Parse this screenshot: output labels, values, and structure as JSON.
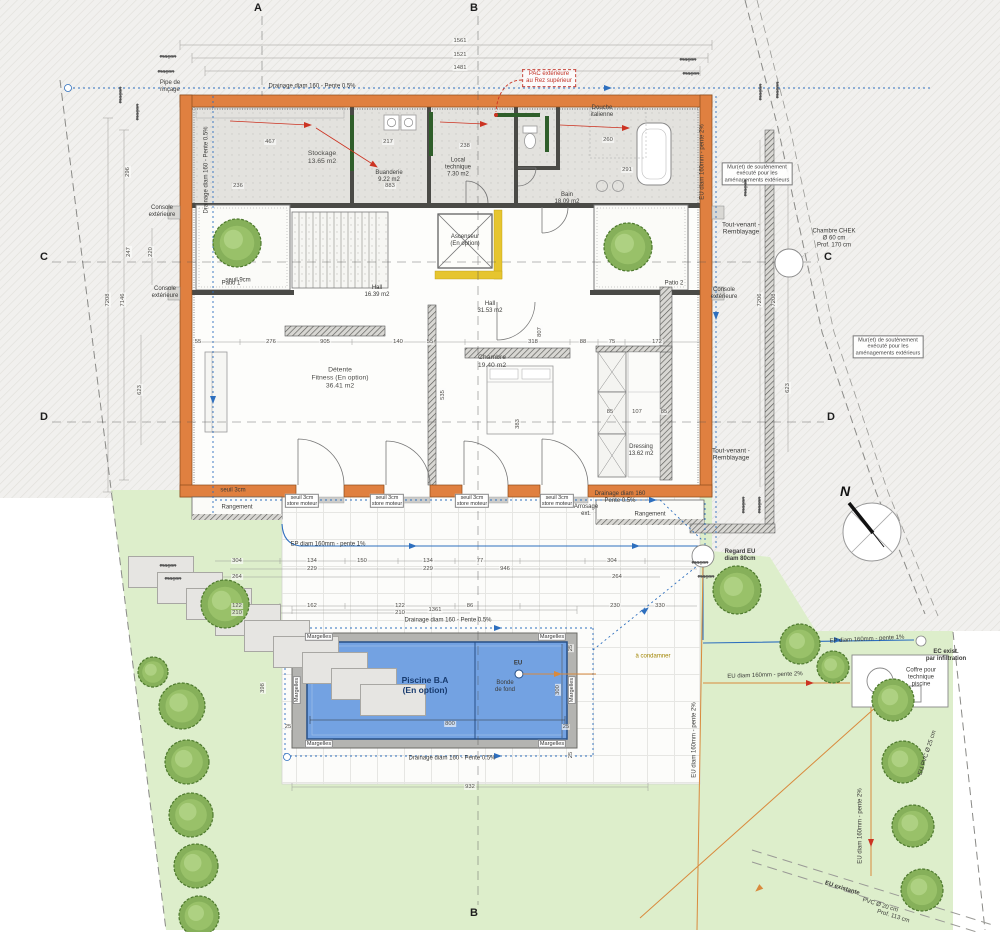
{
  "colors": {
    "wall_orange": "#e08040",
    "water_blue": "#73a2e2",
    "lawn_green": "#ddeecb",
    "terrain_hatch": "#f1f0ee",
    "line_blue": "#2e6fbe",
    "line_orange": "#d98a3d",
    "accent_red": "#cc3322",
    "insulation_yellow": "#e6c52f",
    "frame_green": "#2f5e2a"
  },
  "labels": [
    {
      "n": "pipe-rincage",
      "t": "Pipe de\nrinçage",
      "x": 170,
      "y": 87,
      "c": "xs"
    },
    {
      "n": "drainage-top",
      "t": "Drainage diam 160 - Pente 0.5%",
      "x": 312,
      "y": 87,
      "c": "xs"
    },
    {
      "n": "drainage-left",
      "t": "Drainage diam 160 - Pente 0.5%",
      "x": 207,
      "y": 170,
      "r": -90,
      "c": "xs"
    },
    {
      "n": "drainage-right",
      "t": "Drainage diam 160\nPente 0.5%",
      "x": 620,
      "y": 498,
      "c": "xs"
    },
    {
      "n": "drainage-pool-top",
      "t": "Drainage diam 160 - Pente 0.5%",
      "x": 448,
      "y": 621,
      "c": "xs"
    },
    {
      "n": "drainage-pool-bottom",
      "t": "Drainage diam 160 - Pente 0.5%",
      "x": 452,
      "y": 759,
      "c": "xs"
    },
    {
      "n": "ep-line-1",
      "t": "EP diam 160mm - pente 1%",
      "x": 328,
      "y": 545,
      "c": "xs"
    },
    {
      "n": "ep-line-2",
      "t": "EP diam 160mm - pente 1%",
      "x": 867,
      "y": 640,
      "r": -3,
      "c": "xs"
    },
    {
      "n": "eu-line-h",
      "t": "EU diam 160mm - pente 2%",
      "x": 765,
      "y": 676,
      "r": -2,
      "c": "xs"
    },
    {
      "n": "eu-line-v1",
      "t": "EU diam 160mm - pente 2%",
      "x": 695,
      "y": 740,
      "r": -90,
      "c": "xs"
    },
    {
      "n": "eu-line-v2",
      "t": "EU diam 160mm - pente 2%",
      "x": 861,
      "y": 826,
      "r": -90,
      "c": "xs"
    },
    {
      "n": "eu-line-v3",
      "t": "EU diam 160mm - pente 2%",
      "x": 703,
      "y": 162,
      "r": -90,
      "c": "xs"
    },
    {
      "n": "ec-exist",
      "t": "EC exist.\npar infiltration",
      "x": 946,
      "y": 656,
      "c": "xs bold"
    },
    {
      "n": "regard-eu",
      "t": "Regard EU\ndiam 80cm",
      "x": 740,
      "y": 556,
      "c": "xs bold"
    },
    {
      "n": "coffre-technique",
      "t": "Coffre pour\ntechnique\npiscine",
      "x": 921,
      "y": 678,
      "c": "xs"
    },
    {
      "n": "tout-venant-1",
      "t": "Tout-venant -\nRemblayage",
      "x": 741,
      "y": 229,
      "c": "sm"
    },
    {
      "n": "tout-venant-2",
      "t": "Tout-venant -\nRemblayage",
      "x": 731,
      "y": 455,
      "c": "sm"
    },
    {
      "n": "muret-soutenement-1",
      "t": "Mur(et) de soutènement\nexécuté pour les\naménagements extérieurs",
      "x": 757,
      "y": 174,
      "c": "box"
    },
    {
      "n": "muret-soutenement-2",
      "t": "Mur(et) de soutènement\nexécuté pour les\naménagements extérieurs",
      "x": 888,
      "y": 347,
      "c": "box"
    },
    {
      "n": "chambre-chek",
      "t": "Chambre CHEK\nØ 60 cm\nProf. 170 cm",
      "x": 834,
      "y": 239,
      "c": "xs"
    },
    {
      "n": "pac-exterieure",
      "t": "PAC extérieure\nau Rez supérieur",
      "x": 549,
      "y": 78,
      "c": "redbox"
    },
    {
      "n": "eu-existante",
      "t": "EU existante",
      "x": 842,
      "y": 889,
      "r": 17,
      "c": "xs bold"
    },
    {
      "n": "eu-existante-pvc",
      "t": "PVC Ø 20 cm",
      "x": 880,
      "y": 906,
      "r": 17,
      "c": "xs"
    },
    {
      "n": "eu-existante-prof",
      "t": "Prof. 113 cm",
      "x": 893,
      "y": 917,
      "r": 17,
      "c": "xs"
    },
    {
      "n": "eu-pvc-25",
      "t": "EU PVC Ø 25 cm",
      "x": 928,
      "y": 753,
      "r": -72,
      "c": "xs"
    },
    {
      "n": "a-condamner",
      "t": "à condamner",
      "x": 653,
      "y": 657,
      "c": "xs olive"
    },
    {
      "n": "margelles-1",
      "t": "Margelles",
      "x": 319,
      "y": 637,
      "c": "chip"
    },
    {
      "n": "margelles-2",
      "t": "Margelles",
      "x": 552,
      "y": 637,
      "c": "chip"
    },
    {
      "n": "margelles-3",
      "t": "Margelles",
      "x": 319,
      "y": 744,
      "c": "chip"
    },
    {
      "n": "margelles-4",
      "t": "Margelles",
      "x": 552,
      "y": 744,
      "c": "chip"
    },
    {
      "n": "margelles-5",
      "t": "Margelles",
      "x": 297,
      "y": 690,
      "r": -90,
      "c": "chip"
    },
    {
      "n": "margelles-6",
      "t": "Margelles",
      "x": 572,
      "y": 690,
      "r": -90,
      "c": "chip"
    },
    {
      "n": "piscine-title",
      "t": "Piscine B.A\n(En option)",
      "x": 425,
      "y": 686,
      "c": "pool-title"
    },
    {
      "n": "bonde-de-fond",
      "t": "Bonde\nde fond",
      "x": 505,
      "y": 687,
      "c": "xs"
    },
    {
      "n": "eu-bonde",
      "t": "EU",
      "x": 518,
      "y": 664,
      "c": "xs bold"
    },
    {
      "n": "room-stockage",
      "t": "Stockage\n13.65 m2",
      "x": 322,
      "y": 158,
      "c": "room"
    },
    {
      "n": "room-buanderie",
      "t": "Buanderie\n9.22 m2",
      "x": 389,
      "y": 177,
      "c": "xs"
    },
    {
      "n": "room-local-technique",
      "t": "Local\ntechnique\n7.30 m2",
      "x": 458,
      "y": 168,
      "c": "xs"
    },
    {
      "n": "room-douche",
      "t": "Douche\nitalienne",
      "x": 602,
      "y": 112,
      "c": "xs"
    },
    {
      "n": "room-bain",
      "t": "Bain\n18.09 m2",
      "x": 567,
      "y": 199,
      "c": "xs"
    },
    {
      "n": "room-hall-1",
      "t": "Hall\n16.39 m2",
      "x": 377,
      "y": 292,
      "c": "xs"
    },
    {
      "n": "room-hall-2",
      "t": "Hall\n31.53 m2",
      "x": 490,
      "y": 308,
      "c": "xs"
    },
    {
      "n": "room-ascenseur",
      "t": "Ascenseur\n(En option)",
      "x": 465,
      "y": 241,
      "c": "xs"
    },
    {
      "n": "room-detente",
      "t": "Détente\nFitness (En option)\n36.41 m2",
      "x": 340,
      "y": 378,
      "c": "room"
    },
    {
      "n": "room-chambre",
      "t": "Chambre\n19.40 m2",
      "x": 492,
      "y": 362,
      "c": "room"
    },
    {
      "n": "room-dressing",
      "t": "Dressing\n13.62 m2",
      "x": 641,
      "y": 451,
      "c": "xs"
    },
    {
      "n": "room-patio-1",
      "t": "Patio 1",
      "x": 231,
      "y": 284,
      "c": "xs"
    },
    {
      "n": "room-patio-2",
      "t": "Patio 2",
      "x": 674,
      "y": 284,
      "c": "xs"
    },
    {
      "n": "room-rangement-l",
      "t": "Rangement",
      "x": 237,
      "y": 508,
      "c": "xs"
    },
    {
      "n": "room-rangement-r",
      "t": "Rangement",
      "x": 650,
      "y": 515,
      "c": "xs"
    },
    {
      "n": "arrosage-ext",
      "t": "Arrosage\next.",
      "x": 586,
      "y": 511,
      "c": "xs"
    },
    {
      "n": "console-ext-1",
      "t": "Console\nextérieure",
      "x": 162,
      "y": 212,
      "c": "xs"
    },
    {
      "n": "console-ext-2",
      "t": "Console\nextérieure",
      "x": 165,
      "y": 293,
      "c": "xs"
    },
    {
      "n": "console-ext-3",
      "t": "Console\nextérieure",
      "x": 724,
      "y": 294,
      "c": "xs"
    },
    {
      "n": "seuil-1",
      "t": "seuil 3cm\nstore moteur",
      "x": 302,
      "y": 501,
      "c": "chip2"
    },
    {
      "n": "seuil-2",
      "t": "seuil 3cm\nstore moteur",
      "x": 387,
      "y": 501,
      "c": "chip2"
    },
    {
      "n": "seuil-3",
      "t": "seuil 3cm\nstore moteur",
      "x": 472,
      "y": 501,
      "c": "chip2"
    },
    {
      "n": "seuil-4",
      "t": "seuil 3cm\nstore moteur",
      "x": 557,
      "y": 501,
      "c": "chip2"
    },
    {
      "n": "seuil-5",
      "t": "seuil 3cm",
      "x": 233,
      "y": 491,
      "c": "xs"
    },
    {
      "n": "seuil-6",
      "t": "seuil 9cm",
      "x": 238,
      "y": 281,
      "c": "xs"
    },
    {
      "n": "macon-1",
      "t": "maçon",
      "x": 168,
      "y": 57,
      "c": "strike"
    },
    {
      "n": "macon-2",
      "t": "maçon",
      "x": 166,
      "y": 72,
      "c": "strike"
    },
    {
      "n": "macon-3",
      "t": "maçon",
      "x": 688,
      "y": 60,
      "c": "strike"
    },
    {
      "n": "macon-4",
      "t": "maçon",
      "x": 691,
      "y": 74,
      "c": "strike"
    },
    {
      "n": "macon-5",
      "t": "maçon",
      "x": 761,
      "y": 92,
      "r": -90,
      "c": "strike"
    },
    {
      "n": "macon-6",
      "t": "maçon",
      "x": 778,
      "y": 90,
      "r": -90,
      "c": "strike"
    },
    {
      "n": "macon-7",
      "t": "maçon",
      "x": 121,
      "y": 95,
      "r": -90,
      "c": "strike"
    },
    {
      "n": "macon-8",
      "t": "maçon",
      "x": 138,
      "y": 112,
      "r": -90,
      "c": "strike"
    },
    {
      "n": "macon-9",
      "t": "maçon",
      "x": 746,
      "y": 188,
      "r": -90,
      "c": "strike"
    },
    {
      "n": "macon-10",
      "t": "maçon",
      "x": 744,
      "y": 505,
      "r": -90,
      "c": "strike"
    },
    {
      "n": "macon-11",
      "t": "maçon",
      "x": 760,
      "y": 505,
      "r": -90,
      "c": "strike"
    },
    {
      "n": "macon-12",
      "t": "maçon",
      "x": 168,
      "y": 566,
      "c": "strike"
    },
    {
      "n": "macon-13",
      "t": "maçon",
      "x": 173,
      "y": 579,
      "c": "strike"
    },
    {
      "n": "macon-14",
      "t": "maçon",
      "x": 700,
      "y": 563,
      "c": "strike"
    },
    {
      "n": "macon-15",
      "t": "maçon",
      "x": 706,
      "y": 577,
      "c": "strike"
    },
    {
      "n": "compass-letter",
      "t": "N",
      "x": 845,
      "y": 491,
      "c": "compassn"
    }
  ],
  "dims": [
    {
      "t": "1561",
      "x": 460,
      "y": 41
    },
    {
      "t": "1521",
      "x": 460,
      "y": 55
    },
    {
      "t": "1481",
      "x": 460,
      "y": 68
    },
    {
      "t": "7208",
      "x": 108,
      "y": 300,
      "r": -90
    },
    {
      "t": "7146",
      "x": 123,
      "y": 300,
      "r": -90
    },
    {
      "t": "623",
      "x": 140,
      "y": 390,
      "r": -90
    },
    {
      "t": "247",
      "x": 129,
      "y": 252,
      "r": -90
    },
    {
      "t": "220",
      "x": 151,
      "y": 252,
      "r": -90
    },
    {
      "t": "296",
      "x": 128,
      "y": 172,
      "r": -90
    },
    {
      "t": "398",
      "x": 263,
      "y": 688,
      "r": -90
    },
    {
      "t": "7206",
      "x": 760,
      "y": 300,
      "r": -90
    },
    {
      "t": "7208",
      "x": 774,
      "y": 300,
      "r": -90
    },
    {
      "t": "623",
      "x": 788,
      "y": 388,
      "r": -90
    },
    {
      "t": "467",
      "x": 270,
      "y": 142
    },
    {
      "t": "217",
      "x": 388,
      "y": 142
    },
    {
      "t": "236",
      "x": 238,
      "y": 186
    },
    {
      "t": "883",
      "x": 390,
      "y": 186
    },
    {
      "t": "238",
      "x": 465,
      "y": 146
    },
    {
      "t": "291",
      "x": 627,
      "y": 170
    },
    {
      "t": "260",
      "x": 608,
      "y": 140
    },
    {
      "t": "55",
      "x": 198,
      "y": 342
    },
    {
      "t": "276",
      "x": 271,
      "y": 342
    },
    {
      "t": "905",
      "x": 325,
      "y": 342
    },
    {
      "t": "140",
      "x": 398,
      "y": 342
    },
    {
      "t": "55",
      "x": 430,
      "y": 342
    },
    {
      "t": "318",
      "x": 533,
      "y": 342
    },
    {
      "t": "88",
      "x": 583,
      "y": 342
    },
    {
      "t": "75",
      "x": 612,
      "y": 342
    },
    {
      "t": "172",
      "x": 657,
      "y": 342
    },
    {
      "t": "535",
      "x": 443,
      "y": 395,
      "r": -90
    },
    {
      "t": "383",
      "x": 518,
      "y": 424,
      "r": -90
    },
    {
      "t": "807",
      "x": 540,
      "y": 332,
      "r": -90
    },
    {
      "t": "85",
      "x": 610,
      "y": 412
    },
    {
      "t": "107",
      "x": 637,
      "y": 412
    },
    {
      "t": "85",
      "x": 664,
      "y": 412
    },
    {
      "t": "304",
      "x": 237,
      "y": 561
    },
    {
      "t": "134",
      "x": 312,
      "y": 561
    },
    {
      "t": "150",
      "x": 362,
      "y": 561
    },
    {
      "t": "134",
      "x": 428,
      "y": 561
    },
    {
      "t": "77",
      "x": 480,
      "y": 561
    },
    {
      "t": "304",
      "x": 612,
      "y": 561
    },
    {
      "t": "229",
      "x": 312,
      "y": 569
    },
    {
      "t": "229",
      "x": 428,
      "y": 569
    },
    {
      "t": "946",
      "x": 505,
      "y": 569
    },
    {
      "t": "264",
      "x": 237,
      "y": 577
    },
    {
      "t": "264",
      "x": 617,
      "y": 577
    },
    {
      "t": "122",
      "x": 237,
      "y": 606
    },
    {
      "t": "162",
      "x": 312,
      "y": 606
    },
    {
      "t": "122",
      "x": 400,
      "y": 606
    },
    {
      "t": "86",
      "x": 470,
      "y": 606
    },
    {
      "t": "230",
      "x": 615,
      "y": 606
    },
    {
      "t": "330",
      "x": 660,
      "y": 606
    },
    {
      "t": "210",
      "x": 237,
      "y": 613
    },
    {
      "t": "210",
      "x": 400,
      "y": 613
    },
    {
      "t": "1361",
      "x": 435,
      "y": 610
    },
    {
      "t": "932",
      "x": 470,
      "y": 787
    },
    {
      "t": "800",
      "x": 450,
      "y": 724
    },
    {
      "t": "25",
      "x": 288,
      "y": 727
    },
    {
      "t": "25",
      "x": 566,
      "y": 727
    },
    {
      "t": "25",
      "x": 571,
      "y": 648,
      "r": -90
    },
    {
      "t": "25",
      "x": 571,
      "y": 755,
      "r": -90
    },
    {
      "t": "300",
      "x": 558,
      "y": 690,
      "r": -90
    }
  ],
  "markers": [
    {
      "n": "section-marker-a-top",
      "t": "A",
      "x": 258,
      "y": 8
    },
    {
      "n": "section-marker-b-top",
      "t": "B",
      "x": 474,
      "y": 8
    },
    {
      "n": "section-marker-b-bottom",
      "t": "B",
      "x": 474,
      "y": 913
    },
    {
      "n": "section-marker-c-left",
      "t": "C",
      "x": 44,
      "y": 257
    },
    {
      "n": "section-marker-c-right",
      "t": "C",
      "x": 828,
      "y": 257
    },
    {
      "n": "section-marker-d-left",
      "t": "D",
      "x": 44,
      "y": 417
    },
    {
      "n": "section-marker-d-right",
      "t": "D",
      "x": 831,
      "y": 417
    }
  ],
  "trees": [
    {
      "x": 237,
      "y": 243,
      "r": 24
    },
    {
      "x": 628,
      "y": 247,
      "r": 24
    },
    {
      "x": 225,
      "y": 604,
      "r": 24
    },
    {
      "x": 153,
      "y": 672,
      "r": 15
    },
    {
      "x": 182,
      "y": 706,
      "r": 23
    },
    {
      "x": 187,
      "y": 762,
      "r": 22
    },
    {
      "x": 191,
      "y": 815,
      "r": 22
    },
    {
      "x": 196,
      "y": 866,
      "r": 22
    },
    {
      "x": 199,
      "y": 916,
      "r": 20
    },
    {
      "x": 737,
      "y": 590,
      "r": 24
    },
    {
      "x": 800,
      "y": 644,
      "r": 20
    },
    {
      "x": 833,
      "y": 667,
      "r": 16
    },
    {
      "x": 893,
      "y": 700,
      "r": 21
    },
    {
      "x": 903,
      "y": 762,
      "r": 21
    },
    {
      "x": 913,
      "y": 826,
      "r": 21
    },
    {
      "x": 922,
      "y": 890,
      "r": 21
    }
  ],
  "steps": [
    {
      "x": 128,
      "y": 556,
      "w": 66,
      "h": 32
    },
    {
      "x": 157,
      "y": 572,
      "w": 66,
      "h": 32
    },
    {
      "x": 186,
      "y": 588,
      "w": 66,
      "h": 32
    },
    {
      "x": 215,
      "y": 604,
      "w": 66,
      "h": 32
    },
    {
      "x": 244,
      "y": 620,
      "w": 66,
      "h": 32
    },
    {
      "x": 273,
      "y": 636,
      "w": 66,
      "h": 32
    },
    {
      "x": 302,
      "y": 652,
      "w": 66,
      "h": 32
    },
    {
      "x": 331,
      "y": 668,
      "w": 66,
      "h": 32
    },
    {
      "x": 360,
      "y": 684,
      "w": 66,
      "h": 32
    }
  ]
}
